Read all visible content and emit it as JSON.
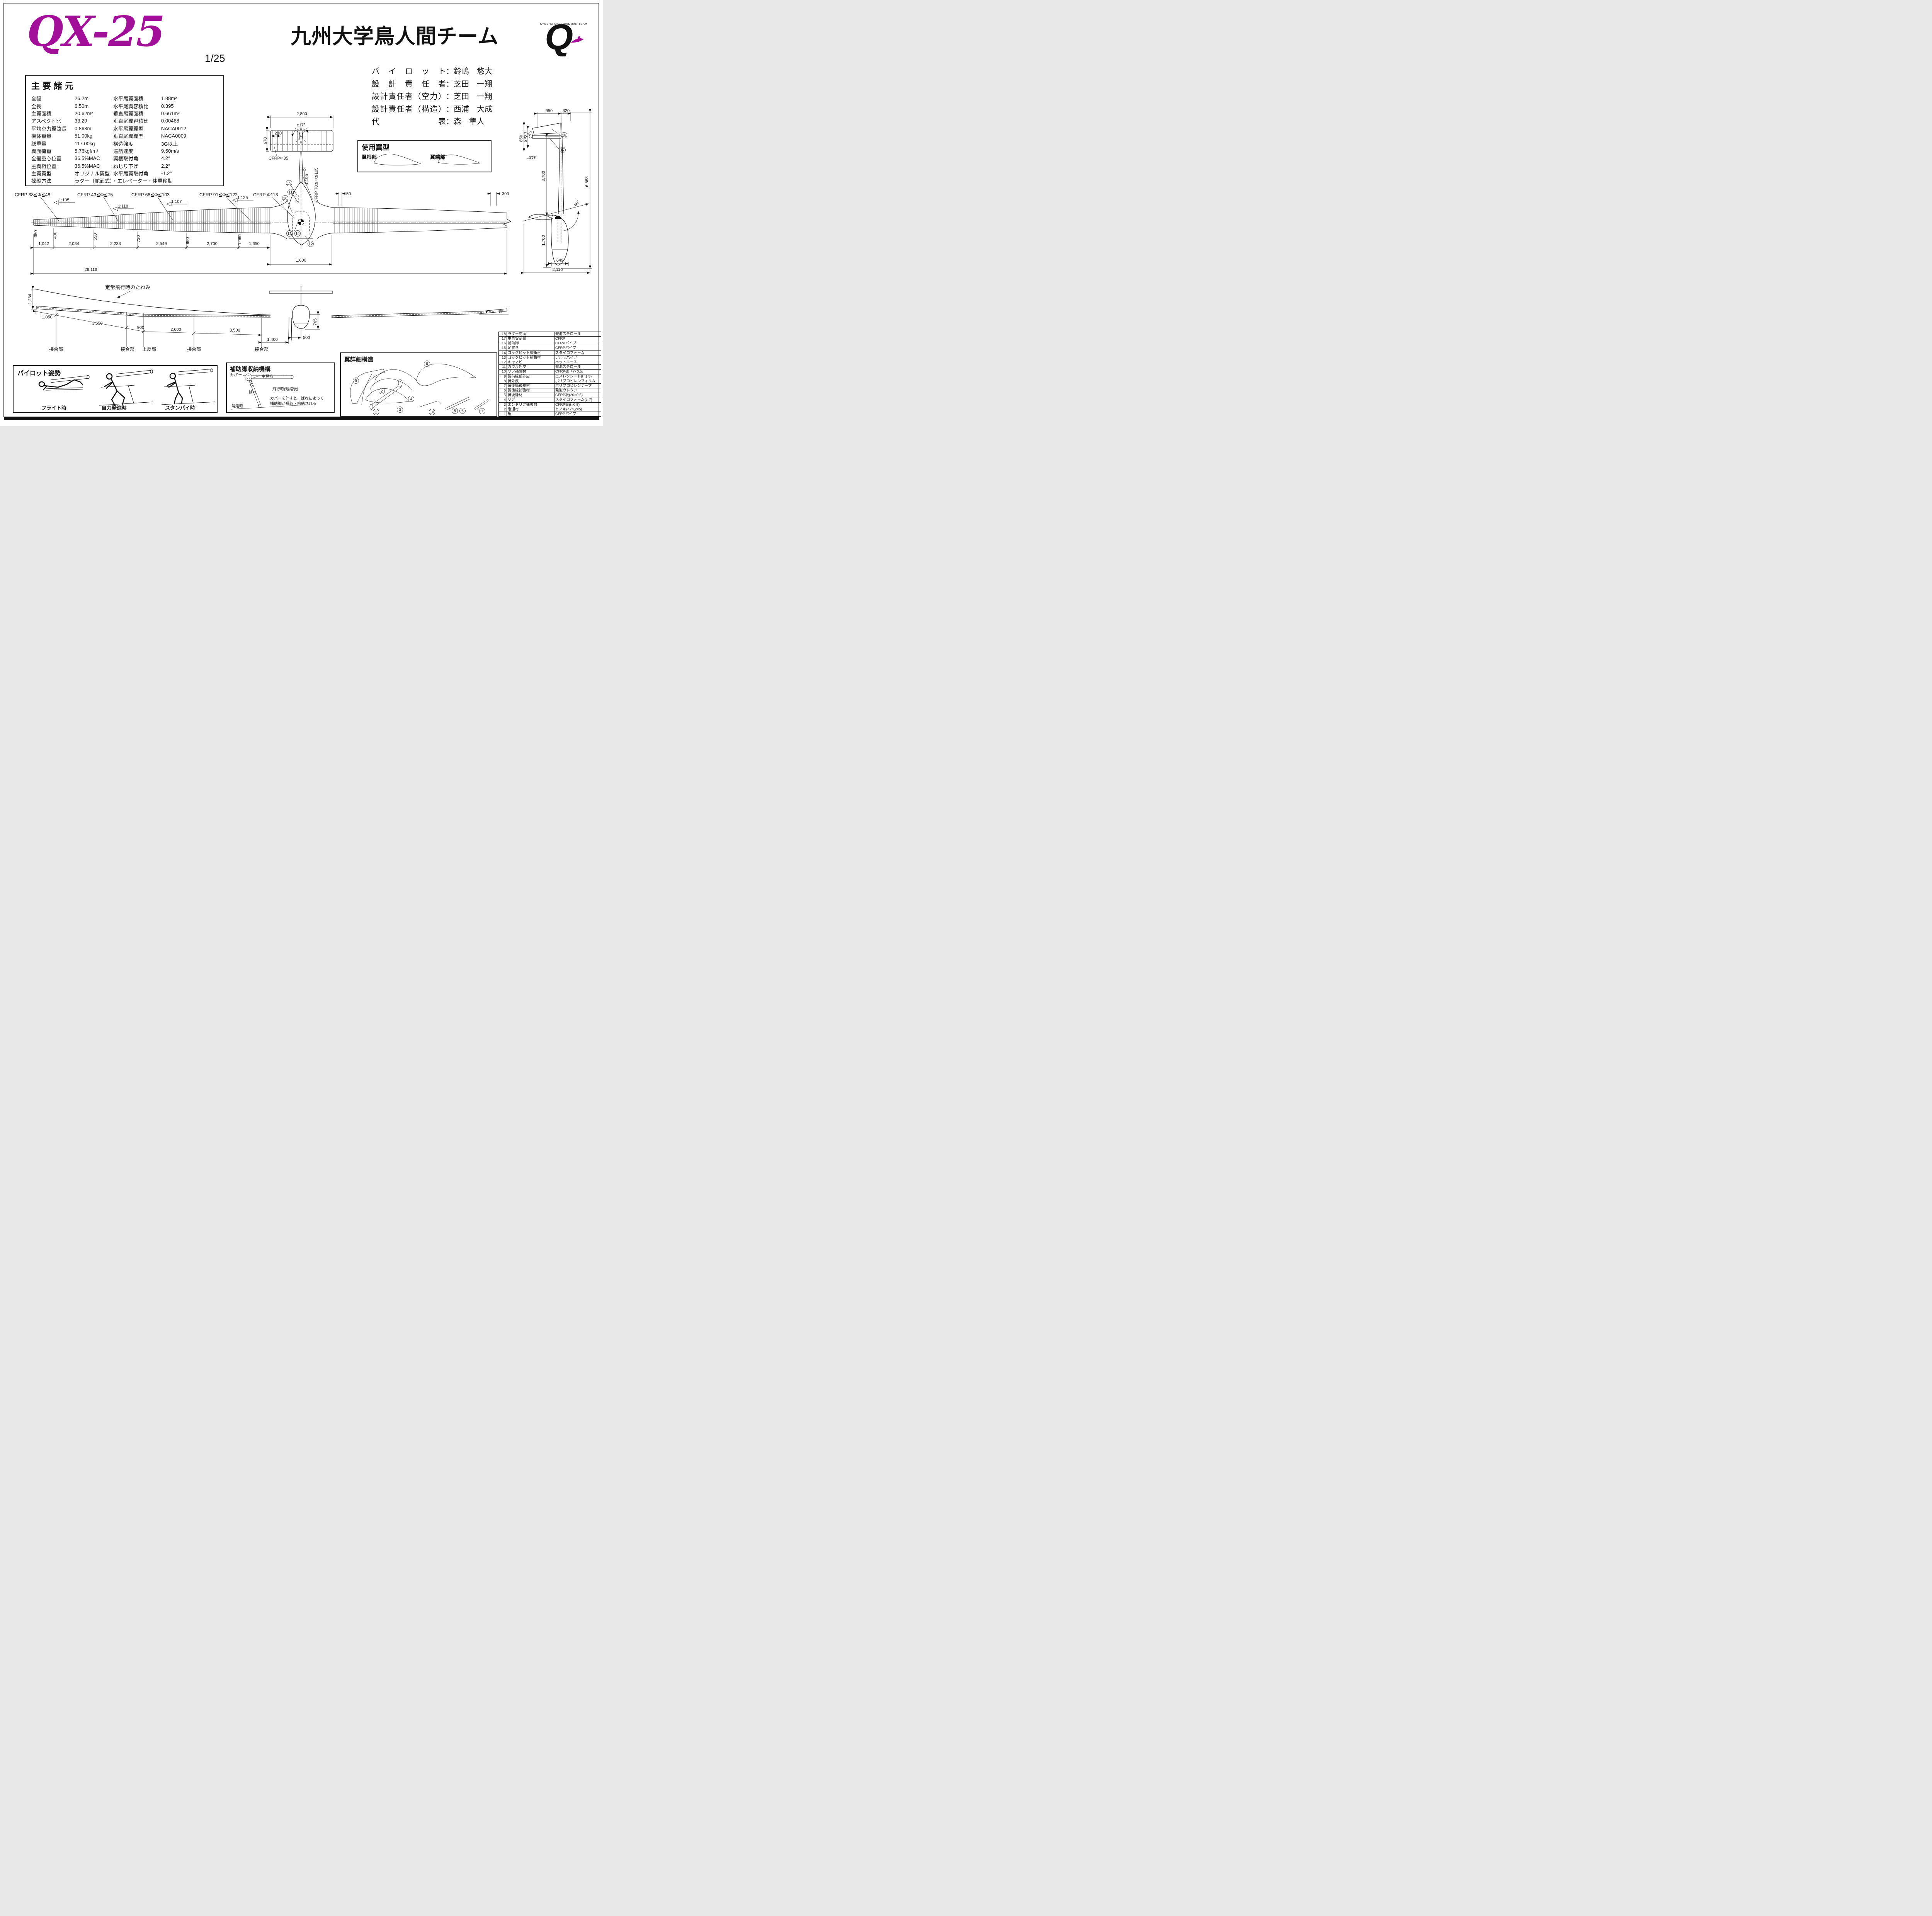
{
  "page": {
    "bg": "#ffffff",
    "ink": "#111111"
  },
  "header": {
    "model": "QX-25",
    "model_color": "#A2109A",
    "scale": "1/25",
    "team": "九州大学鳥人間チーム",
    "logo_letter": "Q",
    "logo_caption": "KYUSHU UNIV BIRDMAN TEAM",
    "logo_caption_color": "#4A5AA8"
  },
  "staff": [
    {
      "role": "パイロット",
      "name": "：鈴嶋　悠大"
    },
    {
      "role": "設計責任者",
      "name": "：芝田　一翔"
    },
    {
      "role": "設計責任者（空力）",
      "name": "：芝田　一翔"
    },
    {
      "role": "設計責任者（構造）",
      "name": "：西浦　大成"
    },
    {
      "role": "代　　　表",
      "name": "：森　隼人"
    }
  ],
  "specs": {
    "title": "主要諸元",
    "rows": [
      {
        "l": "全幅",
        "lv": "26.2m",
        "r": "水平尾翼面積",
        "rv": "1.88m²"
      },
      {
        "l": "全長",
        "lv": "6.50m",
        "r": "水平尾翼容積比",
        "rv": "0.395"
      },
      {
        "l": "主翼面積",
        "lv": "20.62m²",
        "r": "垂直尾翼面積",
        "rv": "0.661m²"
      },
      {
        "l": "アスペクト比",
        "lv": "33.29",
        "r": "垂直尾翼容積比",
        "rv": "0.00468"
      },
      {
        "l": "平均空力翼弦長",
        "lv": "0.863m",
        "r": "水平尾翼翼型",
        "rv": "NACA0012"
      },
      {
        "l": "機体重量",
        "lv": "51.00kg",
        "r": "垂直尾翼翼型",
        "rv": "NACA0009"
      },
      {
        "l": "総重量",
        "lv": "117.00kg",
        "r": "構造強度",
        "rv": "3G以上"
      },
      {
        "l": "翼面荷重",
        "lv": "5.76kgf/m²",
        "r": "巡航速度",
        "rv": "9.50m/s"
      },
      {
        "l": "全備重心位置",
        "lv": "36.5%MAC",
        "r": "翼根取付角",
        "rv": "4.2°"
      },
      {
        "l": "主翼桁位置",
        "lv": "36.5%MAC",
        "r": "ねじり下げ",
        "rv": "2.2°"
      },
      {
        "l": "主翼翼型",
        "lv": "オリジナル翼型",
        "r": "水平尾翼取付角",
        "rv": "-1.2°"
      }
    ],
    "control": {
      "l": "操縦方法",
      "lv": "ラダー（舵面式）・エレベーター・体重移動"
    }
  },
  "airfoil_box": {
    "title": "使用翼型",
    "root": "翼根部",
    "tip": "翼端部"
  },
  "top_view": {
    "htail_span": "2,800",
    "htail_rib_pitch": "210",
    "rudder_throw": "±17°",
    "htail_chord": "670",
    "htail_spar": "CFRPΦ35",
    "boom_taper": "1:105",
    "boom_spar": "CFRP 70≦Φ≦105",
    "spar_labels": [
      "CFRP 38≦Φ≦48",
      "CFRP 43≦Φ≦75",
      "CFRP 68≦Φ≦103",
      "CFRP 91≦Φ≦122",
      "CFRP Φ113"
    ],
    "taper_labels": [
      "1:105",
      "1:118",
      "1:107",
      "1:125"
    ],
    "chords": [
      "350",
      "400",
      "550",
      "730",
      "960",
      "1,060"
    ],
    "spans": [
      "1,042",
      "2,084",
      "2,233",
      "2,549",
      "2,700",
      "1,650"
    ],
    "rib_pitch_inner": "150",
    "rib_pitch_outer": "300",
    "fuselage_width": "1,600",
    "total_span": "26,116",
    "callouts": [
      "15",
      "11",
      "16",
      "13",
      "14",
      "12"
    ],
    "callout_comma": "，"
  },
  "side_view": {
    "rudder_chord": "950",
    "aft": "320",
    "height_outer": "850",
    "height_inner": "670",
    "elevator_throw": "±10°",
    "boom_length": "3,700",
    "total_height": "6,568",
    "wing_angle": "80°",
    "pod_depth": "1,700",
    "pod_width": "649",
    "total_length": "2,116",
    "callouts": [
      "18",
      "17"
    ]
  },
  "front_view": {
    "tip_deflection": "1,234",
    "deflection_note": "定常飛行時のたわみ",
    "seg": [
      "1,050",
      "3,650",
      "900",
      "2,600",
      "3,500"
    ],
    "leg_offset": "1,400",
    "leg_center": "500",
    "pod_below": "765",
    "dihedral_tip": "7°",
    "joints": [
      "接合部",
      "接合部",
      "上反部",
      "接合部",
      "接合部"
    ]
  },
  "pilot_box": {
    "title": "パイロット姿勢",
    "poses": [
      "フライト時",
      "自力発進時",
      "スタンバイ時"
    ]
  },
  "leg_box": {
    "title": "補助脚収納機構",
    "cover": "カバー",
    "spar": "主翼桁",
    "spring": "ばね",
    "flight": "飛行時(短縮後)",
    "run": "滑走時",
    "note1": "カバーを外すと，ばねによって",
    "note2": "補助脚が短縮・格納される"
  },
  "wing_detail": {
    "title": "翼詳細構造",
    "callouts": [
      "1",
      "2",
      "3",
      "4",
      "5",
      "6",
      "7",
      "8",
      "9",
      "10"
    ],
    "comma": "，"
  },
  "parts_table": {
    "rows": [
      {
        "no": "18",
        "name": "ラダー舵面",
        "mat": "発泡スチロール"
      },
      {
        "no": "17",
        "name": "垂直安定板",
        "mat": "CFRP"
      },
      {
        "no": "16",
        "name": "補助脚",
        "mat": "CFRPパイプ"
      },
      {
        "no": "15",
        "name": "足置き",
        "mat": "CFRPパイプ"
      },
      {
        "no": "14",
        "name": "コックピット緩衝材",
        "mat": "スタイロフォーム"
      },
      {
        "no": "13",
        "name": "コックピット補強材",
        "mat": "アルミパイプ"
      },
      {
        "no": "12",
        "name": "キャノピ",
        "mat": "ペットエース"
      },
      {
        "no": "11",
        "name": "カウル外皮",
        "mat": "発泡スチロール"
      },
      {
        "no": "10",
        "name": "リブ補強材",
        "mat": "CFRP板（7×0.5）"
      },
      {
        "no": "9",
        "name": "翼前縁部外皮",
        "mat": "エスレンシート(t=1.5)"
      },
      {
        "no": "8",
        "name": "翼外皮",
        "mat": "ポリプロピレンフィルム"
      },
      {
        "no": "7",
        "name": "翼後縁被覆材",
        "mat": "ポリプロピレンテープ"
      },
      {
        "no": "6",
        "name": "翼後縁補強材",
        "mat": "発泡ウレタン"
      },
      {
        "no": "5",
        "name": "翼後縁材",
        "mat": "CFRP板(20×0.5)"
      },
      {
        "no": "4",
        "name": "リブ",
        "mat": "スタイロフォーム(t=7)"
      },
      {
        "no": "3",
        "name": "エンドリブ補強材",
        "mat": "CFRP板(t=0.5)"
      },
      {
        "no": "2",
        "name": "縦通材",
        "mat": "ヒノキ(4×4,2×5)"
      },
      {
        "no": "1",
        "name": "桁",
        "mat": "CFRPパイプ"
      }
    ]
  }
}
